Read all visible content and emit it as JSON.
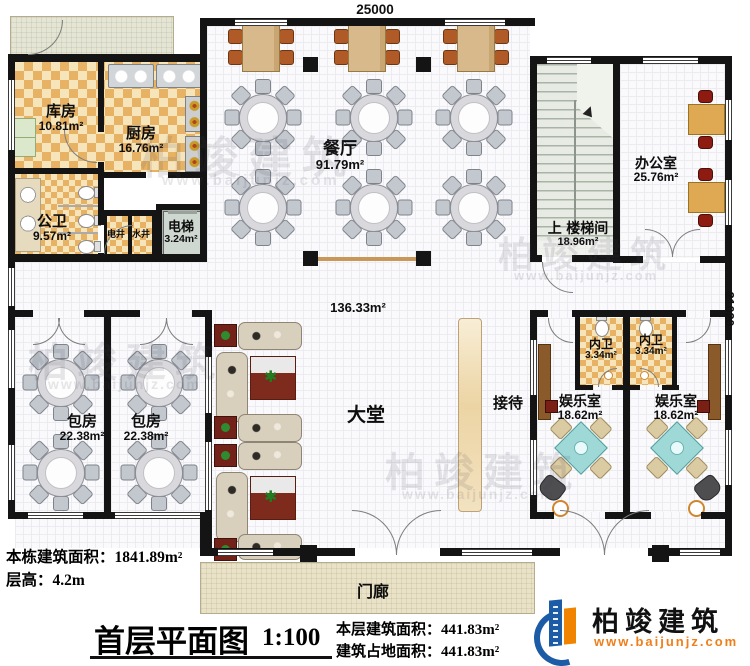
{
  "dims": {
    "top": "25000",
    "right": "21020"
  },
  "rooms": {
    "kufang": {
      "name": "库房",
      "area": "10.81m²"
    },
    "chufang": {
      "name": "厨房",
      "area": "16.76m²"
    },
    "gongwei": {
      "name": "公卫",
      "area": "9.57m²"
    },
    "dianjing": {
      "name": "电井"
    },
    "shuijing": {
      "name": "水井"
    },
    "dianti": {
      "name": "电梯",
      "area": "3.24m²"
    },
    "canting": {
      "name": "餐厅",
      "area": "91.79m²"
    },
    "loutijian": {
      "prefix": "上",
      "name": "楼梯间",
      "area": "18.96m²"
    },
    "bangongshi": {
      "name": "办公室",
      "area": "25.76m²"
    },
    "datang": {
      "name": "大堂",
      "area": "136.33m²"
    },
    "jiedai": {
      "name": "接待"
    },
    "baofang": {
      "name": "包房",
      "area": "22.38m²"
    },
    "neiwei": {
      "name": "内卫",
      "area": "3.34m²"
    },
    "yuleshi": {
      "name": "娱乐室",
      "area": "18.62m²"
    },
    "menlang": {
      "name": "门廊"
    }
  },
  "notes": {
    "building_area_label": "本栋建筑面积：",
    "building_area": "1841.89m²",
    "floor_height_label": "层高：",
    "floor_height": "4.2m",
    "title": "首层平面图",
    "scale": "1:100",
    "floor_area_label": "本层建筑面积：",
    "floor_area": "441.83m²",
    "footprint_label": "建筑占地面积：",
    "footprint": "441.83m²"
  },
  "brand": {
    "name": "柏竣建筑",
    "url": "www.baijunjz.com"
  },
  "watermark": {
    "name": "柏竣建筑",
    "url": "www.baijunjz.com"
  }
}
